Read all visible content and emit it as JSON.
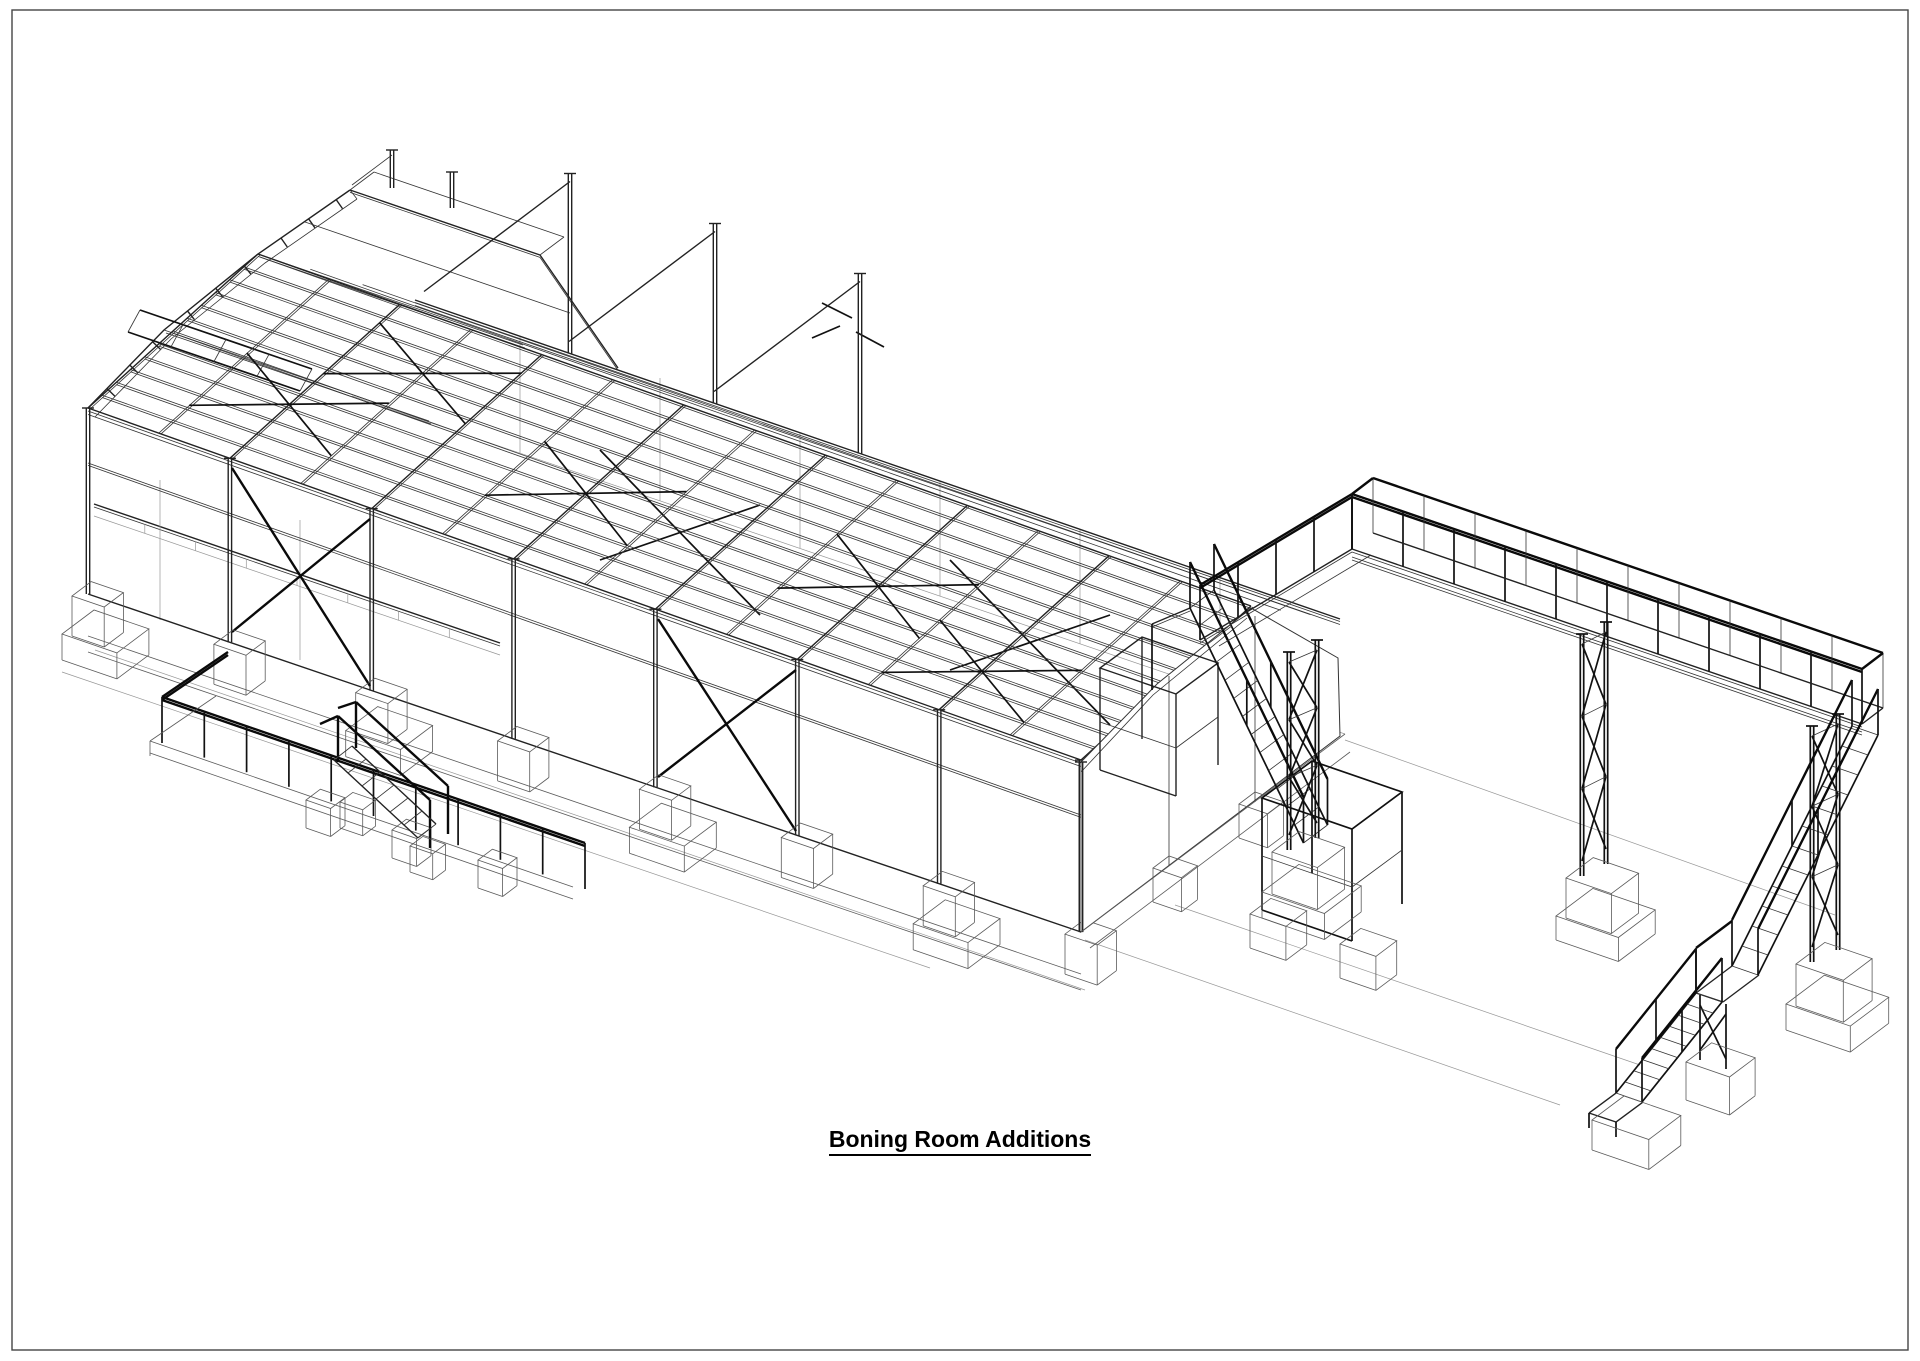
{
  "page": {
    "background": "#ffffff",
    "border_color": "#454545",
    "line_color": "#222222"
  },
  "drawing": {
    "title": "Boning Room Additions",
    "title_color": "#000000",
    "type": "isometric-structural-wireframe",
    "visible_parts": [
      "main roof purlin grid with cross bracing",
      "faceted curved roof over left mezzanine section",
      "front portal columns with X bracing",
      "concrete plinths and ground beams",
      "right gable wall",
      "front yard guardrail and small access stair",
      "elevated walkway on X-braced towers",
      "external stairs with mid landing and footings"
    ]
  }
}
